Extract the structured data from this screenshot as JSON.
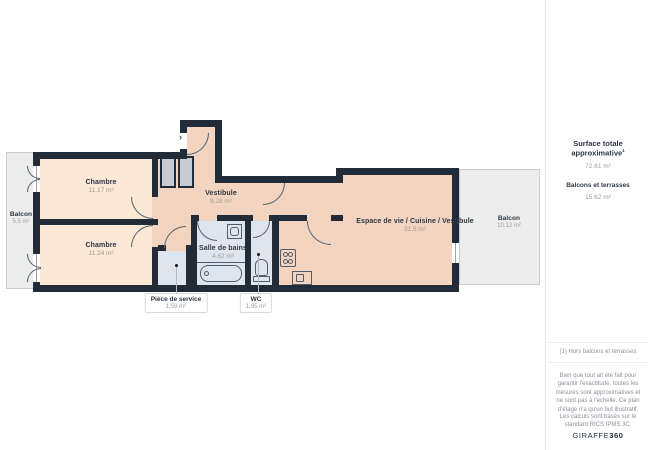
{
  "plan": {
    "rooms": [
      {
        "id": "balcony-left",
        "name": "Balcon",
        "area": "5.5 m²"
      },
      {
        "id": "bedroom-1",
        "name": "Chambre",
        "area": "11.17 m²"
      },
      {
        "id": "bedroom-2",
        "name": "Chambre",
        "area": "11.24 m²"
      },
      {
        "id": "vestibule",
        "name": "Vestibule",
        "area": "9.28 m²"
      },
      {
        "id": "bathroom",
        "name": "Salle de bains",
        "area": "4.62 m²"
      },
      {
        "id": "living",
        "name": "Espace de vie / Cuisine / Vestibule",
        "area": "31.5 m²"
      },
      {
        "id": "balcony-right",
        "name": "Balcon",
        "area": "10.12 m²"
      }
    ],
    "callouts": [
      {
        "id": "service-room",
        "name": "Pièce de service",
        "area": "1.59 m²"
      },
      {
        "id": "wc",
        "name": "WC",
        "area": "1.95 m²"
      }
    ]
  },
  "sidebar": {
    "total_label": "Surface totale approximative",
    "total_sup": "1",
    "total_value": "72.61 m²",
    "balconies_label": "Balcons et terrasses",
    "balconies_value": "15.62 m²",
    "footnote": "(1) Hors balcons et terrasses",
    "disclaimer": "Bien que tout ait été fait pour garantir l'exactitude, toutes les mesures sont approximatives et ne sont pas à l'échelle. Ce plan d'étage n'a qu'un but illustratif.",
    "standard": "Les calculs sont basés sur le standard RICS IPMS 3C.",
    "logo_prefix": "GIRAFFE",
    "logo_suffix": "360"
  },
  "colors": {
    "wall": "#222c38",
    "bedroom_fill": "#fbe8d5",
    "living_fill": "#f2d4c1",
    "wet_room_fill": "#dfe5ee",
    "balcony_fill": "#ededee",
    "text_dark": "#2e3744",
    "text_muted": "#a29b92"
  }
}
